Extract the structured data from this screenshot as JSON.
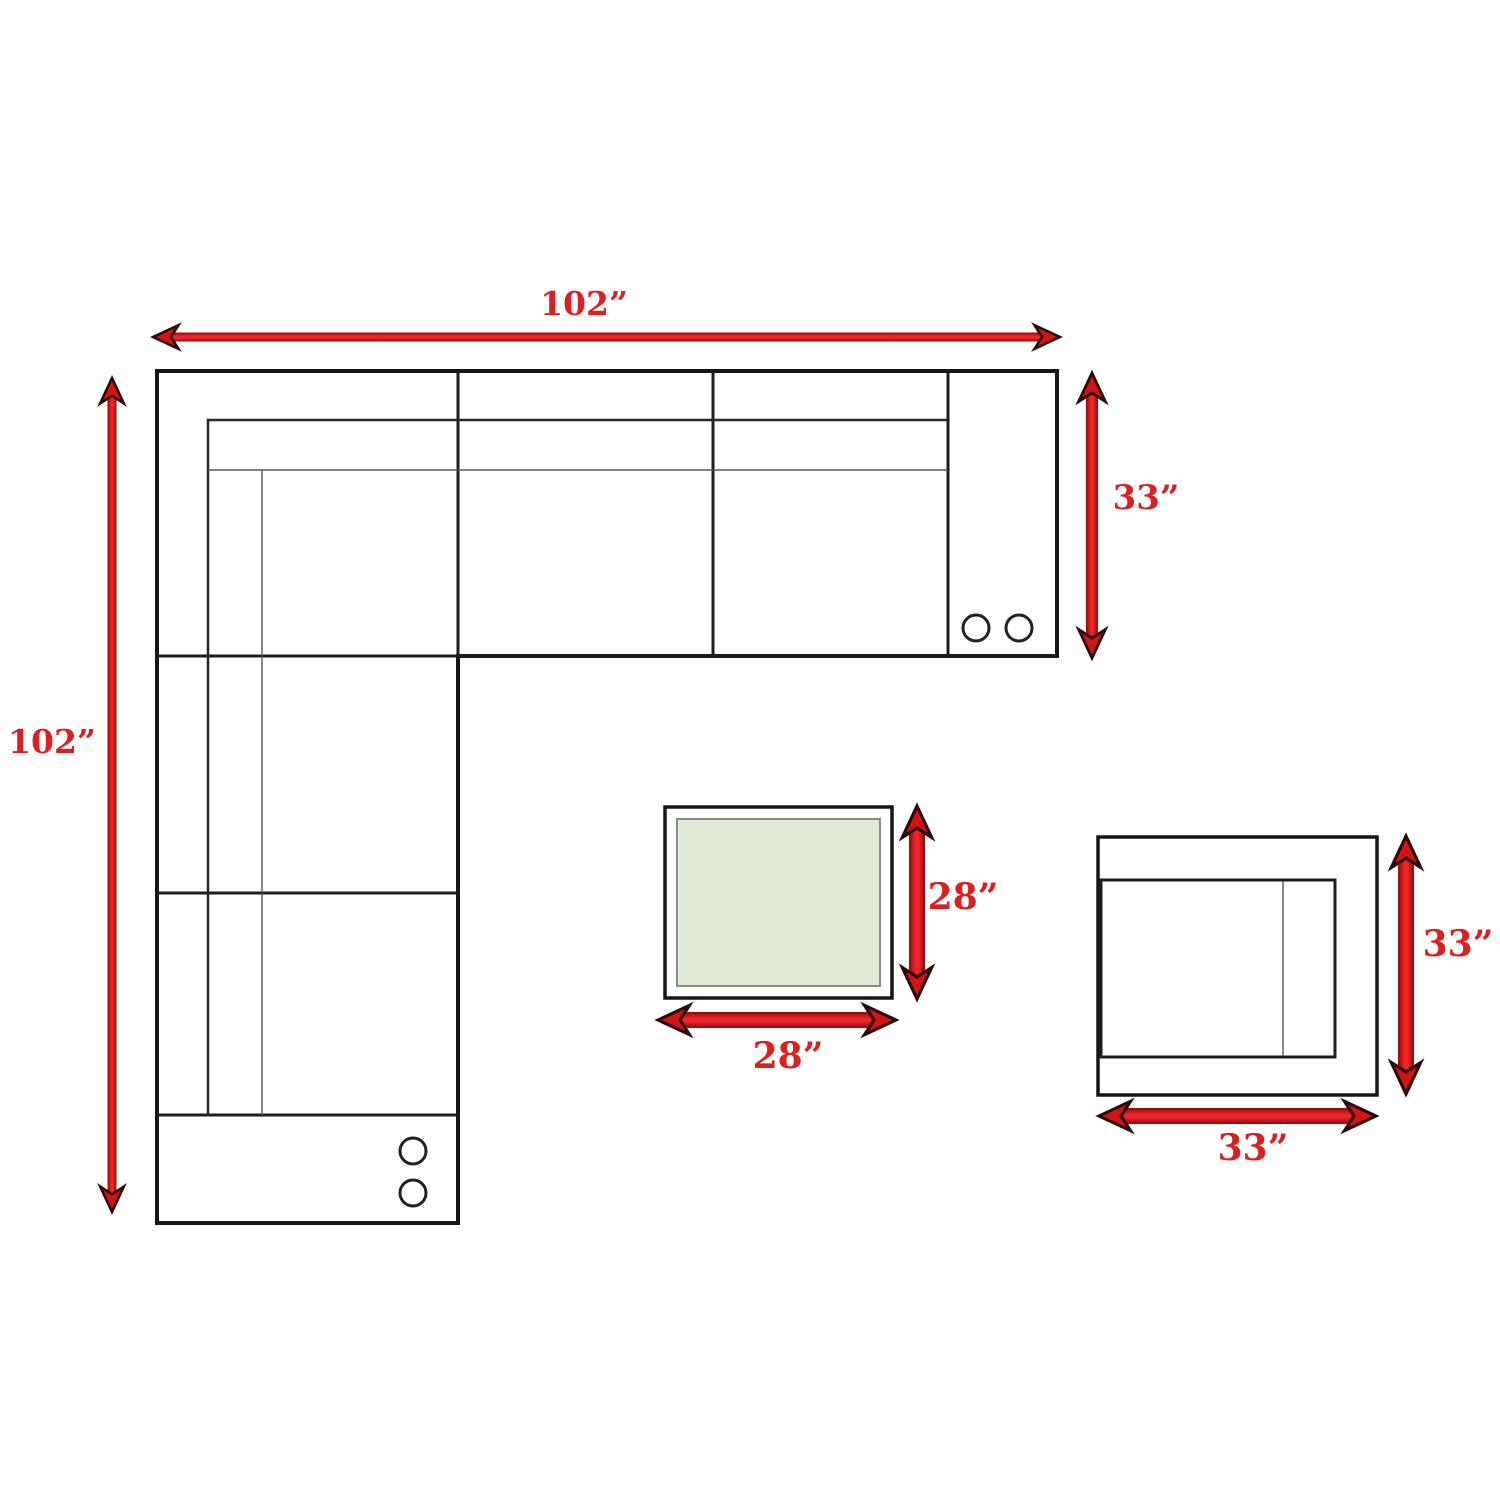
{
  "diagram_title": "sectional-sofa-dimension-plan",
  "sectional": {
    "width_label": "102”",
    "height_label": "102”",
    "depth_label": "33”"
  },
  "coffee_table": {
    "depth_label": "28”",
    "width_label": "28”"
  },
  "chair": {
    "depth_label": "33”",
    "width_label": "33”"
  },
  "colors": {
    "outline": "#161616",
    "inner_line": "#262626",
    "thin_line": "#555555",
    "arrow_red": "#d31414",
    "arrow_dark_edge": "#8e0909",
    "arrow_head_stroke": "#2a0b0b",
    "label_red": "#d92121",
    "table_top_green": "#e1ead4"
  }
}
